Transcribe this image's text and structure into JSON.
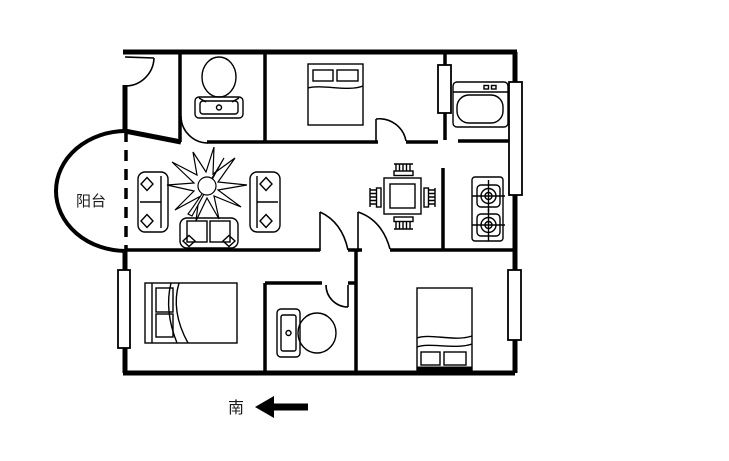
{
  "plan": {
    "type": "apartment-floor-plan",
    "labels": {
      "balcony": "阳台",
      "south": "南"
    },
    "colors": {
      "background": "#ffffff",
      "line": "#000000",
      "text": "#1b1b1b"
    },
    "icons": {
      "bathroom_top": "toilet-icon",
      "bedroom_top": "double-bed-icon",
      "utility_room": "washing-machine-icon",
      "kitchen": "gas-stove-two-burner-icon",
      "dining_area": "dining-table-four-chairs-icon",
      "living_room": [
        "sofa-icon",
        "sofa-icon",
        "loveseat-icon",
        "plant-icon"
      ],
      "bedroom_left": "bed-icon",
      "bathroom_bottom": "toilet-icon",
      "bedroom_right": "double-bed-icon",
      "compass": "south-arrow-icon"
    }
  }
}
